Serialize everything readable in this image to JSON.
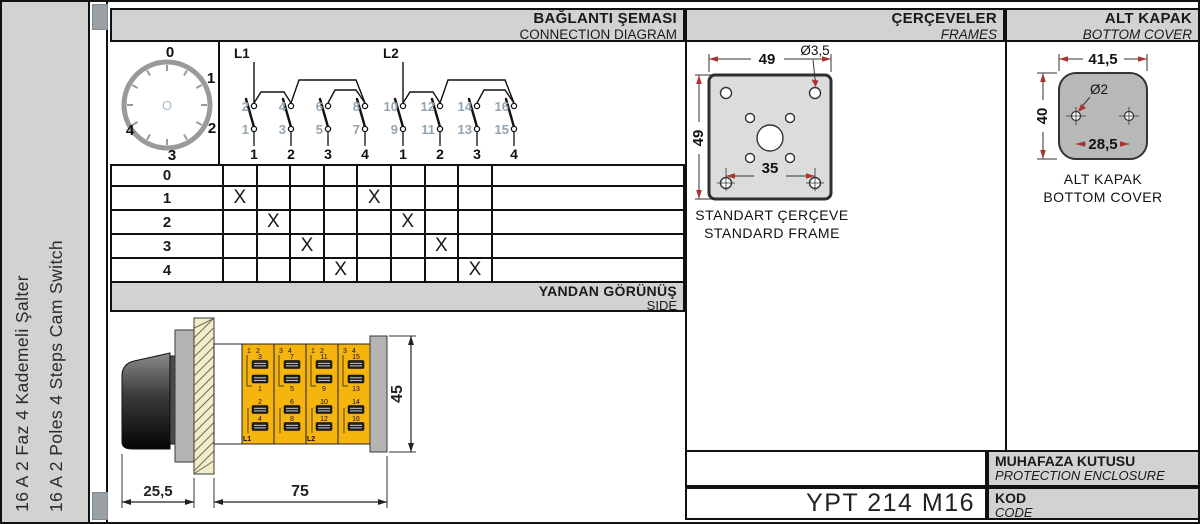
{
  "sidebar": {
    "title_tr": "16 A 2 Faz 4 Kademeli Şalter",
    "title_en": "16 A 2 Poles 4 Steps Cam Switch"
  },
  "sections": {
    "connection": {
      "title": "BAĞLANTI ŞEMASI",
      "subtitle": "CONNECTION DIAGRAM"
    },
    "frames": {
      "title": "ÇERÇEVELER",
      "subtitle": "FRAMES"
    },
    "bottom_cover": {
      "title": "ALT KAPAK",
      "subtitle": "BOTTOM COVER"
    },
    "side": {
      "title": "YANDAN GÖRÜNÜŞ",
      "subtitle": "SIDE"
    },
    "enclosure": {
      "title": "MUHAFAZA KUTUSU",
      "subtitle": "PROTECTION ENCLOSURE"
    },
    "code": {
      "title": "KOD",
      "subtitle": "CODE",
      "value": "YPT 214 M16"
    }
  },
  "dial": {
    "positions": [
      "0",
      "1",
      "2",
      "3",
      "4"
    ],
    "center": "O"
  },
  "diagram": {
    "feeds": [
      "L1",
      "L2"
    ],
    "poles": [
      {
        "feed": "L1",
        "contacts": [
          {
            "top": "2",
            "bottom": "1",
            "out": "1"
          },
          {
            "top": "4",
            "bottom": "3",
            "out": "2"
          },
          {
            "top": "6",
            "bottom": "5",
            "out": "3"
          },
          {
            "top": "8",
            "bottom": "7",
            "out": "4"
          }
        ]
      },
      {
        "feed": "L2",
        "contacts": [
          {
            "top": "10",
            "bottom": "9",
            "out": "1"
          },
          {
            "top": "12",
            "bottom": "11",
            "out": "2"
          },
          {
            "top": "14",
            "bottom": "13",
            "out": "3"
          },
          {
            "top": "16",
            "bottom": "15",
            "out": "4"
          }
        ]
      }
    ]
  },
  "chart_data": {
    "type": "table",
    "title": "Cam switch contact closing table",
    "row_labels": [
      "0",
      "1",
      "2",
      "3",
      "4"
    ],
    "col_labels": [
      "1",
      "2",
      "3",
      "4",
      "1",
      "2",
      "3",
      "4"
    ],
    "marks": [
      [
        "",
        "",
        "",
        "",
        "",
        "",
        "",
        ""
      ],
      [
        "X",
        "",
        "",
        "",
        "X",
        "",
        "",
        ""
      ],
      [
        "",
        "X",
        "",
        "",
        "",
        "X",
        "",
        ""
      ],
      [
        "",
        "",
        "X",
        "",
        "",
        "",
        "X",
        ""
      ],
      [
        "",
        "",
        "",
        "X",
        "",
        "",
        "",
        "X"
      ]
    ]
  },
  "frame_drawing": {
    "dim_width": "49",
    "dim_height": "49",
    "dim_holes": "Ø3,5",
    "dim_inner": "35",
    "caption_tr": "STANDART ÇERÇEVE",
    "caption_en": "STANDARD FRAME"
  },
  "cover_drawing": {
    "dim_width": "41,5",
    "dim_height": "40",
    "dim_hole": "Ø2",
    "dim_span": "28,5",
    "caption_tr": "ALT KAPAK",
    "caption_en": "BOTTOM COVER"
  },
  "side_drawing": {
    "dim_knob": "25,5",
    "dim_body": "75",
    "dim_height": "45",
    "columns": [
      {
        "corner": [
          "1",
          "2"
        ],
        "upper": [
          "3",
          "1"
        ],
        "lower": [
          "2",
          "4"
        ],
        "feed": "L1"
      },
      {
        "corner": [
          "3",
          "4"
        ],
        "upper": [
          "7",
          "5"
        ],
        "lower": [
          "6",
          "8"
        ],
        "feed": ""
      },
      {
        "corner": [
          "1",
          "2"
        ],
        "upper": [
          "11",
          "9"
        ],
        "lower": [
          "10",
          "12"
        ],
        "feed": "L2"
      },
      {
        "corner": [
          "3",
          "4"
        ],
        "upper": [
          "15",
          "13"
        ],
        "lower": [
          "14",
          "16"
        ],
        "feed": ""
      }
    ]
  },
  "colors": {
    "accent_yellow": "#f6b40e",
    "header_gray": "#d2d2d2",
    "drawing_gray": "#b8b8b8",
    "dim_arrow_red": "#b03030",
    "terminal_number_gray": "#93a5b1"
  }
}
